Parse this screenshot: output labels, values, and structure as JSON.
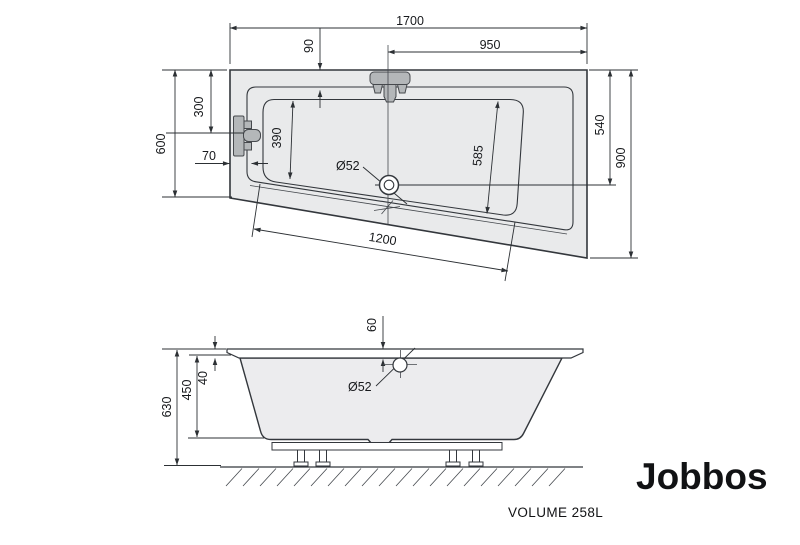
{
  "colors": {
    "line": "#33373c",
    "tub_fill": "#e9eaeb",
    "fixture_fill": "#b4b7b9",
    "background": "#ffffff"
  },
  "top_view": {
    "overall_length": "1700",
    "center_to_right": "950",
    "rim_inset": "90",
    "overflow_from_top": "300",
    "left_side_width": "600",
    "corner_offset": "70",
    "basin_left_width": "390",
    "basin_right_width": "585",
    "drain_from_top": "540",
    "right_side_width": "900",
    "bottom_edge_length": "1200",
    "drain_diameter": "Ø52"
  },
  "side_view": {
    "total_height": "630",
    "tub_depth": "450",
    "rim_thickness": "40",
    "drain_offset": "60",
    "drain_diameter": "Ø52"
  },
  "footer": {
    "volume_label": "VOLUME 258L",
    "product_name": "Jobbos"
  }
}
